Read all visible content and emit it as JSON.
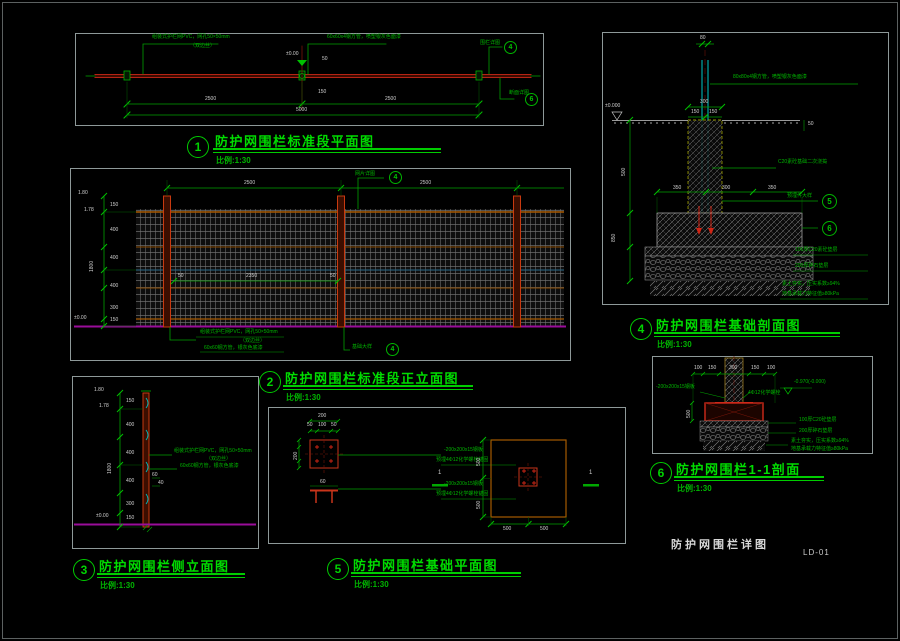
{
  "footer": {
    "title": "防护网围栏详图",
    "sheet": "LD-01"
  },
  "d1": {
    "num": "1",
    "title": "防护网围栏标准段平面图",
    "scale": "比例:1:30",
    "mesh1": "组装式护栏网PVC，网孔50×50mm",
    "mesh2": "（双边丝）",
    "post": "60x60x4钢方管，喷塑银灰色面漆",
    "level": "±0.00",
    "dimA": "2500",
    "dimB": "2500",
    "dimTotal": "5000",
    "dimS1": "50",
    "dimS2": "150",
    "co_top": "围栏详图",
    "co_top_n": "4",
    "co_bot": "断面详图",
    "co_bot_n": "6"
  },
  "d2": {
    "num": "2",
    "title": "防护网围栏标准段正立面图",
    "scale": "比例:1:30",
    "dimA": "2500",
    "dimB": "2500",
    "dimMid": "2350",
    "s50a": "50",
    "s50b": "50",
    "lv1": "1.80",
    "lv2": "1.78",
    "lvl0": "±0.00",
    "hTotal": "1800",
    "seg1": "150",
    "seg2": "400",
    "seg3": "400",
    "seg4": "400",
    "seg5": "300",
    "seg6": "150",
    "mesh1": "组装式护栏网PVC，网孔50×50mm",
    "mesh2": "（双边丝）",
    "post": "60x60钢方管，银灰色底漆",
    "co_top": "网片详图",
    "co_top_n": "4",
    "co_bot": "基础大样",
    "co_bot_n": "4"
  },
  "d3": {
    "num": "3",
    "title": "防护网围栏侧立面图",
    "scale": "比例:1:30",
    "lv1": "1.80",
    "lv2": "1.78",
    "lvl0": "±0.00",
    "hTotal": "1800",
    "seg1": "150",
    "seg2": "400",
    "seg3": "400",
    "seg4": "400",
    "seg5": "300",
    "seg6": "150",
    "mesh1": "组装式护栏网PVC，网孔50×50mm",
    "mesh2": "（双边丝）",
    "post": "60x60钢方管，银灰色底漆",
    "dimA": "60",
    "dimB": "40"
  },
  "d4": {
    "num": "4",
    "title": "防护网围栏基础剖面图",
    "scale": "比例:1:30",
    "dimTop": "80",
    "post": "80x80x4钢方管，喷塑银灰色面漆",
    "level": "±0.000",
    "grout": "C20素砼基础二次浇捣",
    "dim300": "300",
    "dim150a": "150",
    "dim150b": "150",
    "dimRow1": "350",
    "dimRow2": "300",
    "dimRow3": "350",
    "dim50": "50",
    "dim500": "500",
    "dim850": "850",
    "co5": "预埋件大样",
    "co5_n": "5",
    "co6_n": "6",
    "cushion": "100厚C20素砼垫层",
    "gravel": "200厚碎石垫层",
    "soil1": "素土夯实，压实系数≥94%",
    "soil2": "地基承载力特征值≥80kPa"
  },
  "d5": {
    "num": "5",
    "title": "防护网围栏基础平面图",
    "scale": "比例:1:30",
    "p200": "200",
    "p50a": "50",
    "p100": "100",
    "p50b": "50",
    "pl200": "200",
    "plateA1": "-200x200x15钢板",
    "plateA2": "预埋4Φ12化学螺栓锚固",
    "plateB1": "-200x200x15钢板",
    "plateB2": "预埋4Φ12化学螺栓锚固",
    "dim60": "60",
    "sec1": "1",
    "sec2": "1",
    "v500a": "500",
    "v500b": "500",
    "h500a": "500",
    "h500b": "500"
  },
  "d6": {
    "num": "6",
    "title": "防护网围栏1-1剖面",
    "scale": "比例:1:30",
    "t100a": "100",
    "t150a": "150",
    "t300": "300",
    "t150b": "150",
    "t100b": "100",
    "plate": "-200x200x15钢板",
    "bolt": "4Φ12化学螺栓",
    "level": "-0.970(-0.000)",
    "v500": "500",
    "cushion": "100厚C20砼垫层",
    "gravel": "200厚碎石垫层",
    "soil1": "素土夯实，压实系数≥94%",
    "soil2": "地基承载力特征值≥80kPa"
  }
}
